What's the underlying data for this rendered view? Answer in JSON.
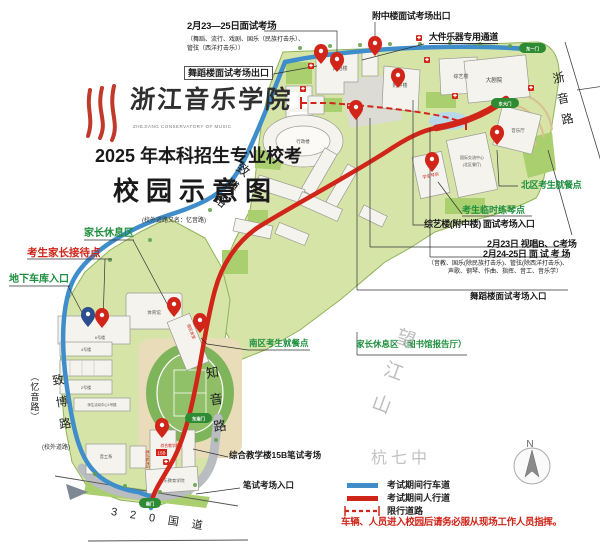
{
  "logo": {
    "name_cn": "浙江音乐学院",
    "name_en": "ZHEJIANG CONSERVATORY OF MUSIC"
  },
  "title": {
    "line1": "2025 年本科招生专业校考",
    "line2": "校园示意图"
  },
  "callouts": {
    "exam0223_title": "2月23—25日面试考场",
    "exam0223_sub1": "（舞蹈、流行、戏剧、国乐（民族打击乐）、",
    "exam0223_sub2": "管弦（西洋打击乐））",
    "wudao_exit": "舞蹈楼面试考场出口",
    "fuzhong_exit": "附中楼面试考场出口",
    "instrument_channel": "大件乐器专用通道",
    "north_dining": "北区考生就餐点",
    "piano_practice": "考生临时练琴点",
    "zongyi_entrance": "综艺楼(附中楼) 面试考场入口",
    "exam0223_sight": "2月23日  视唱B、C考场",
    "exam0224_title": "2月24-25日 面 试 考 场",
    "exam0224_sub1": "（音教、国乐(除民族打击乐)、管弦(除西洋打击乐)、",
    "exam0224_sub2": "声歌、钢琴、作曲、指挥、音工、音乐学）",
    "wudao_entrance": "舞蹈楼面试考场入口",
    "parents_rest_library": "家长休息区（图书馆报告厅）",
    "parents_rest": "家长休息区",
    "parents_reception": "考生家长接待点",
    "garage_entrance": "地下车库入口",
    "south_dining": "南区考生就餐点",
    "written_exam_15b": "综合教学楼15B笔试考场",
    "written_entrance": "笔试考场入口"
  },
  "roads": {
    "zheyin": "浙音路",
    "zhibo_upper": "致博路",
    "zhibo_upper_note": "(校外道路又名：忆音路)",
    "zhibo_lower": "致博路",
    "zhibo_lower_alias": "（忆音路）",
    "zhibo_lower_note": "(校外道路)",
    "zhiyin": "知音路",
    "g320": "3 2 0 国 道"
  },
  "places": {
    "wangjiangshan": "望江山",
    "hangqizhong": "杭七中"
  },
  "buildings": {
    "wudaolou": "舞蹈楼",
    "fuzhonglou": "附中楼",
    "zongyilou": "综艺楼",
    "dajuyuan": "大剧院",
    "xingzhenglou": "行政楼",
    "yinyueting": "音乐厅",
    "intl_center_1": "国际交流中心",
    "intl_center_2": "(北区餐厅)",
    "xueshengqinfang": "学生琴房",
    "tiyuguan": "体育馆",
    "liuhaolou": "6号楼",
    "nanqushitang": "南区食堂",
    "sihaolou": "4号楼",
    "erhaolou": "2号楼",
    "yihaolou": "师生活动中心1号楼",
    "yingongxi": "音工系",
    "zonghelou": "综合教学楼",
    "b15": "15B",
    "bishi_area": "笔试候考区",
    "yinjiao_xueyuan": "音乐教育学院"
  },
  "gates": {
    "dongyimen": "东一门",
    "dongdamen": "东大门",
    "dongnanmen": "东南门",
    "nanmen": "南门"
  },
  "legend": {
    "drive": "考试期间行车道",
    "walk": "考试期间人行道",
    "restricted": "限行道路",
    "notice": "车辆、人员进入校园后请务必服从现场工作人员指挥。",
    "compass_n": "N"
  },
  "colors": {
    "drive_blue": "#3f8ecb",
    "walk_red": "#d2251a",
    "green_text": "#1e8f3e",
    "campus_green": "#d6e4a8"
  }
}
